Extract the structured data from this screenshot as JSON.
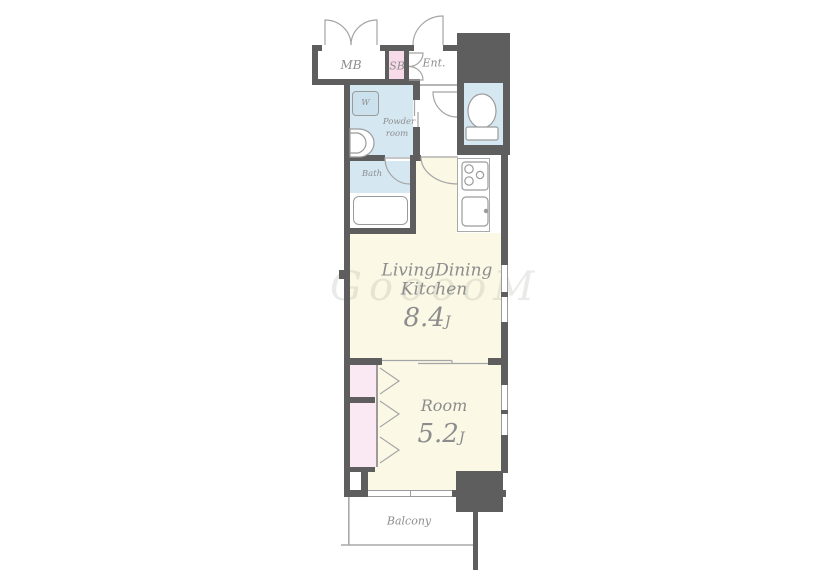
{
  "plan": {
    "title": "apartment-floor-plan-1ldk",
    "labels": {
      "mb": "MB",
      "sb": "SB",
      "ent": "Ent.",
      "washer": "W",
      "powder_line1": "Powder",
      "powder_line2": "room",
      "bath": "Bath",
      "ldk_line1": "LivingDining",
      "ldk_line2": "Kitchen",
      "ldk_size": "8.4",
      "ldk_size_unit": "J",
      "room": "Room",
      "room_size": "5.2",
      "room_size_unit": "J",
      "balcony": "Balcony"
    },
    "watermark": "GooooM",
    "colors": {
      "wall": "#5e5e5e",
      "room_cream": "#fbf8e6",
      "wet_area_blue": "#d5e8f2",
      "washer_blue": "#cce1ee",
      "sb_pink": "#f7dbe8",
      "closet_pink": "#fae9f2",
      "label_gray": "#8d8d8d",
      "fixture_outline": "#9b9b9b"
    }
  }
}
